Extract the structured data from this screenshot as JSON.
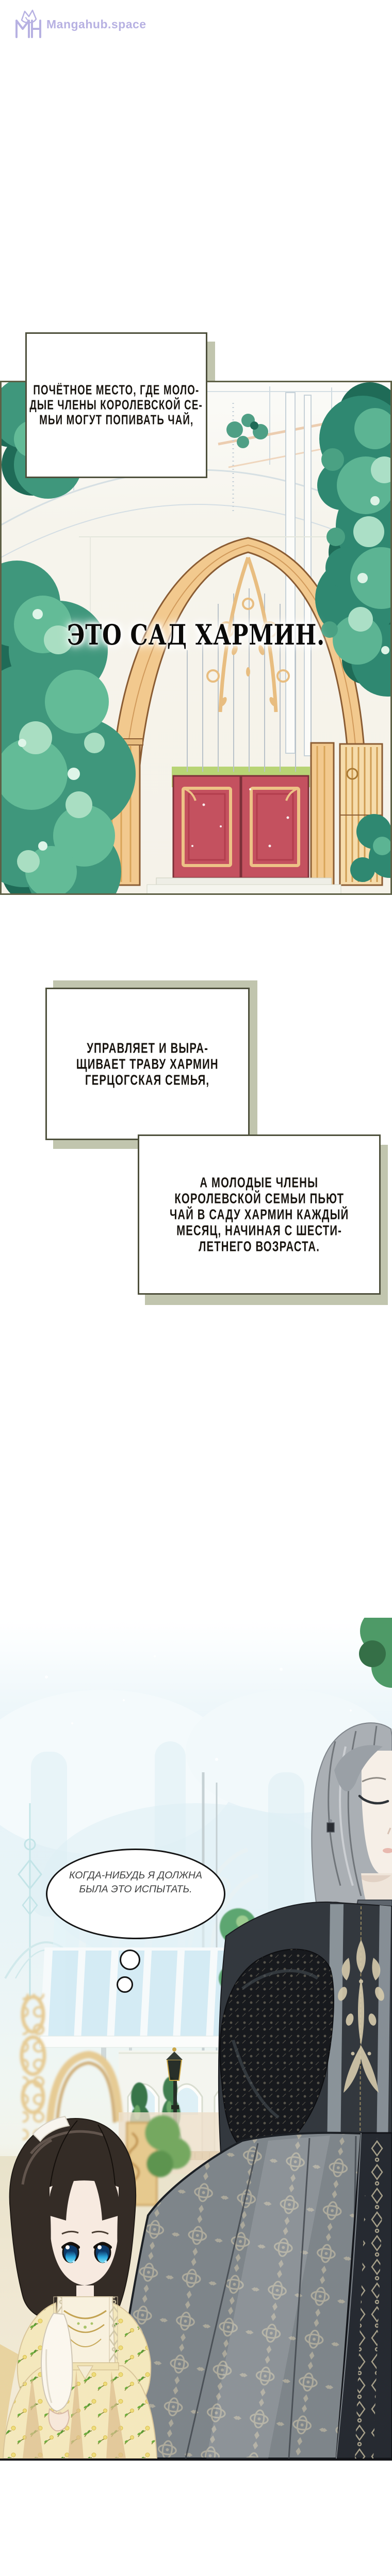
{
  "site": {
    "name": "Mangahub.space",
    "monogram": "MH"
  },
  "narration": {
    "box1": {
      "lines": [
        "ПОЧЁТНОЕ МЕСТО, ГДЕ МОЛО-",
        "ДЫЕ ЧЛЕНЫ КОРОЛЕВСКОЙ СЕ-",
        "МЬИ МОГУТ ПОПИВАТЬ ЧАЙ,"
      ]
    },
    "box2": {
      "lines": [
        "УПРАВЛЯЕТ И ВЫРА-",
        "ЩИВАЕТ ТРАВУ ХАРМИН",
        "ГЕРЦОГСКАЯ СЕМЬЯ,"
      ]
    },
    "box3": {
      "lines": [
        "А МОЛОДЫЕ ЧЛЕНЫ",
        "КОРОЛЕВСКОЙ СЕМЬИ ПЬЮТ",
        "ЧАЙ В САДУ ХАРМИН КАЖДЫЙ",
        "МЕСЯЦ, НАЧИНАЯ С ШЕСТИ-",
        "ЛЕТНЕГО ВОЗРАСТА."
      ]
    }
  },
  "garden": {
    "title": "ЭТО САД ХАРМИН."
  },
  "bubble": {
    "lines": [
      "КОГДА-НИБУДЬ Я ДОЛЖНА",
      "БЫЛА ЭТО ИСПЫТАТЬ."
    ]
  },
  "colors": {
    "logo": "#b7b1e2",
    "box_border": "#4e503c",
    "box_shadow": "#c1c5ae",
    "panel_border": "#5e6046",
    "ink": "#17130e",
    "gate_gold": "#f2c98e",
    "door_red": "#c4515f",
    "foliage_teal": "#2f8871",
    "scene_glass": "#cfe9f3",
    "floor_beige": "#efe7d2",
    "bubble_border": "#141414"
  }
}
